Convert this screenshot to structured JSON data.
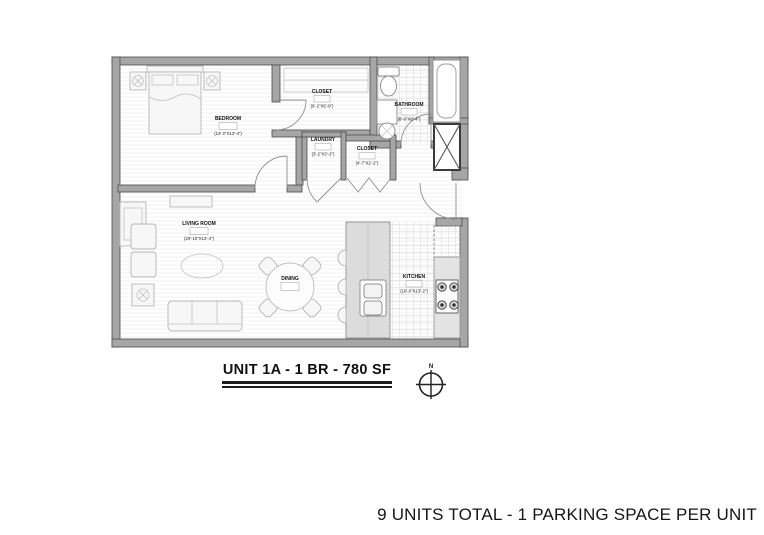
{
  "plan": {
    "title": "UNIT 1A - 1 BR - 780 SF",
    "north_label": "N",
    "rooms": [
      {
        "name": "BEDROOM",
        "dims": "(13'-2\"X13'-4\")"
      },
      {
        "name": "CLOSET",
        "dims": "(9'-2\"X5'-9\")"
      },
      {
        "name": "BATHROOM",
        "dims": "(8'-0\"X8'-4\")"
      },
      {
        "name": "LAUNDRY",
        "dims": "(3'-2\"X3'-2\")"
      },
      {
        "name": "CLOSET",
        "dims": "(4'-7\"X2'-2\")"
      },
      {
        "name": "LIVING ROOM",
        "dims": "(20'-10\"X13'-4\")"
      },
      {
        "name": "DINING",
        "dims": ""
      },
      {
        "name": "KITCHEN",
        "dims": "(10'-0\"X13'-2\")"
      }
    ],
    "colors": {
      "wall_fill": "#a6a6a6",
      "wall_stroke": "#4c4c4c",
      "floor_hatch": "#ededed",
      "ink": "#1c1c1c"
    }
  },
  "footer": {
    "note": "9 UNITS TOTAL - 1 PARKING SPACE PER UNIT"
  }
}
